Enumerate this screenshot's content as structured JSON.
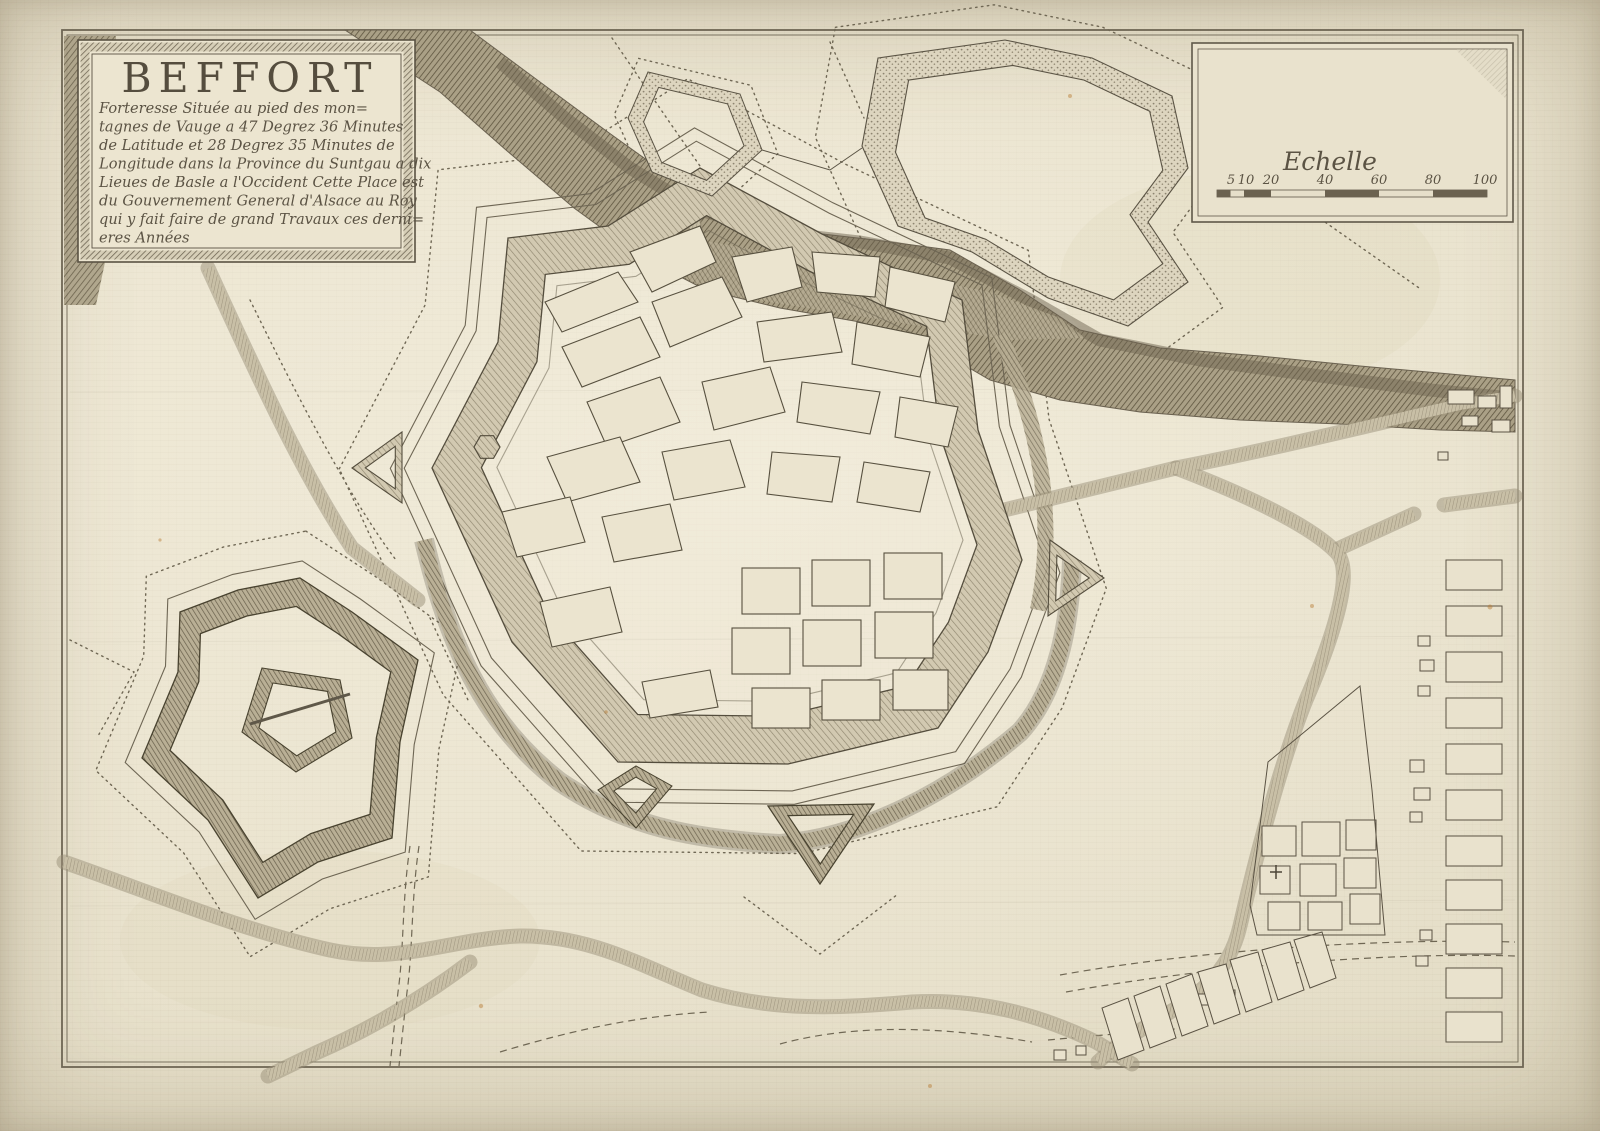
{
  "cartouche": {
    "title": "BEFFORT",
    "lines": [
      "Forteresse Située au pied des mon=",
      "tagnes de Vauge a 47 Degrez 36 Minutes",
      "de Latitude et 28 Degrez 35 Minutes de",
      "Longitude dans la Province du Suntgau a dix",
      "Lieues de Basle a l'Occident Cette Place est",
      "du Gouvernement General d'Alsace au Roy",
      "qui y fait faire de grand Travaux ces derni=",
      "eres Années"
    ]
  },
  "scale": {
    "label": "Echelle",
    "ticks": [
      "5",
      "10",
      "20",
      "40",
      "60",
      "80",
      "100"
    ]
  },
  "colors": {
    "paper": "#e8e1cc",
    "ink": "#4c4537",
    "hatch": "#8d8471",
    "river": "#6e6450",
    "stain": "#b5782f"
  }
}
